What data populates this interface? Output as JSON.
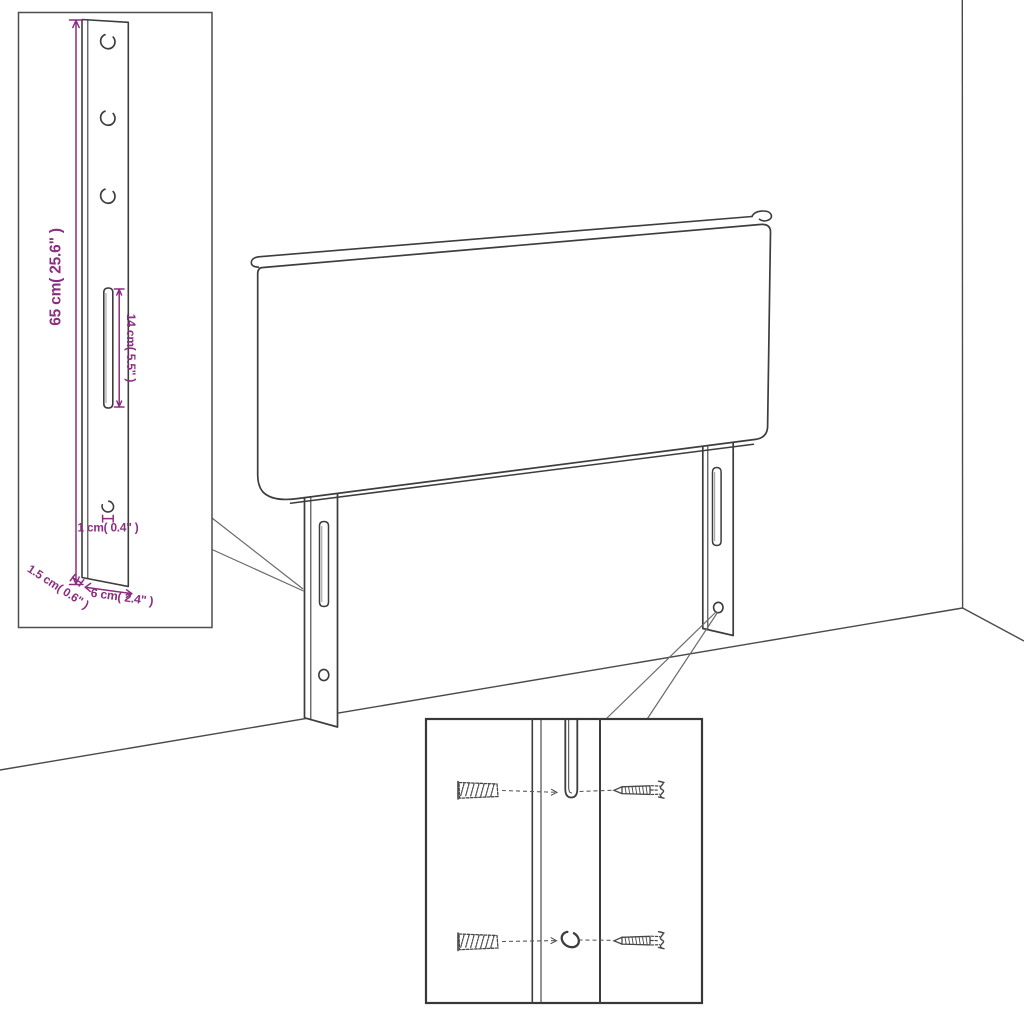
{
  "diagram": {
    "kind": "furniture-assembly-line-drawing",
    "subject": "upholstered headboard with two mounting legs in a room corner",
    "colors": {
      "background": "#ffffff",
      "line": "#3d3d3d",
      "dimension": "#8b2e80"
    },
    "bracket_inset": {
      "description": "enlarged detail of mounting leg bracket",
      "top_hole_count": 3,
      "dimensions": {
        "height": "65 cm( 25.6\" )",
        "slot_length": "14 cm( 5.5\" )",
        "hole_diameter": "1 cm( 0.4\" )",
        "thickness": "1.5 cm( 0.6\" )",
        "width": "6 cm( 2.4\" )"
      }
    },
    "mounting_inset": {
      "description": "enlarged detail of leg with wall plugs and screws",
      "wall_plug_count": 2,
      "screw_count": 2
    }
  }
}
